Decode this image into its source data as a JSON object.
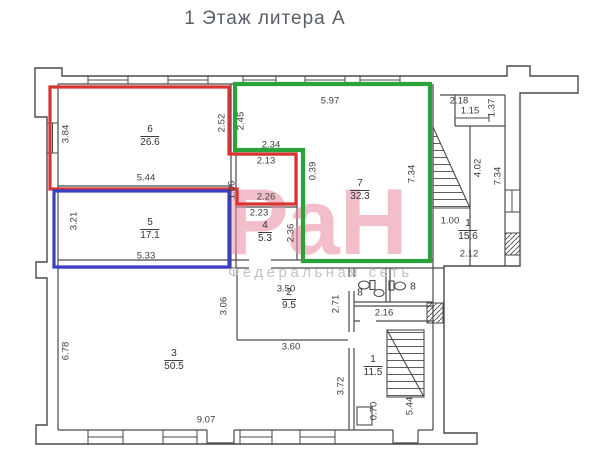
{
  "title": "1 Этаж литера А",
  "watermark": {
    "text": "РаН",
    "subtitle": "Федеральная сеть"
  },
  "colors": {
    "red_outline": "#d93434",
    "green_outline": "#2ba33b",
    "blue_outline": "#3b3fc4",
    "walls": "#4a4a4a",
    "watermark_pink": "#e989a0",
    "watermark_gray": "#c4c4c4",
    "title_gray": "#5a5f66"
  },
  "rooms": [
    {
      "number": "6",
      "area": "26.6"
    },
    {
      "number": "5",
      "area": "17.1"
    },
    {
      "number": "7",
      "area": "32.3"
    },
    {
      "number": "4",
      "area": "5.3"
    },
    {
      "number": "1",
      "area": "15.6"
    },
    {
      "number": "2",
      "area": "9.5"
    },
    {
      "number": "3",
      "area": "50.5"
    },
    {
      "number": "1",
      "area": "11.5"
    },
    {
      "number": "8",
      "area": ""
    },
    {
      "number": "8",
      "area": ""
    }
  ],
  "dims": [
    "5.97",
    "2.18",
    "1.15",
    "2.34",
    "2.13",
    "5.44",
    "2.26",
    "2.23",
    "1.00",
    "2.12",
    "5.33",
    "3.50",
    "2.16",
    "3.60",
    "9.07",
    "3.84",
    "2.52",
    "2.45",
    "0.39",
    "7.34",
    "1.37",
    "4.02",
    "7.34",
    "1.06",
    "2.36",
    "3.21",
    "3.06",
    "2.71",
    "6.78",
    "3.72",
    "0.70",
    "5.44"
  ]
}
